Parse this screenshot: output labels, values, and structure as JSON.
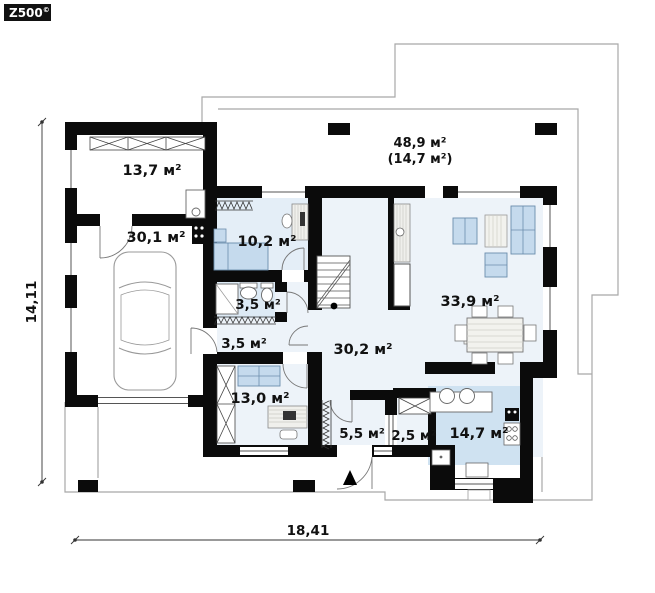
{
  "logo": {
    "brand": "Z500",
    "copyright": "©"
  },
  "dimensions": {
    "horizontal": "18,41",
    "vertical": "14,11"
  },
  "terrace": {
    "area": "48,9 м²",
    "area_alt": "(14,7 м²)"
  },
  "rooms": {
    "storage": "13,7 м²",
    "garage": "30,1 м²",
    "bedroom": "10,2 м²",
    "bathroom": "3,5 м²",
    "hallway_small": "3,5 м²",
    "bedroom2": "13,0 м²",
    "hall": "30,2 м²",
    "living_room": "33,9 м²",
    "entry": "5,5 м²",
    "wardrobe": "2,5 м²",
    "kitchen": "14,7 м²"
  },
  "colors": {
    "wall": "#0b0b0b",
    "outline": "#a8a8a8",
    "floor_pale": "#edf3f9",
    "floor_bedroom": "#e4eef7",
    "floor_bath": "#ddeaf5",
    "floor_kitchen": "#cfe2f1",
    "furniture_blue": "#c5daed"
  }
}
